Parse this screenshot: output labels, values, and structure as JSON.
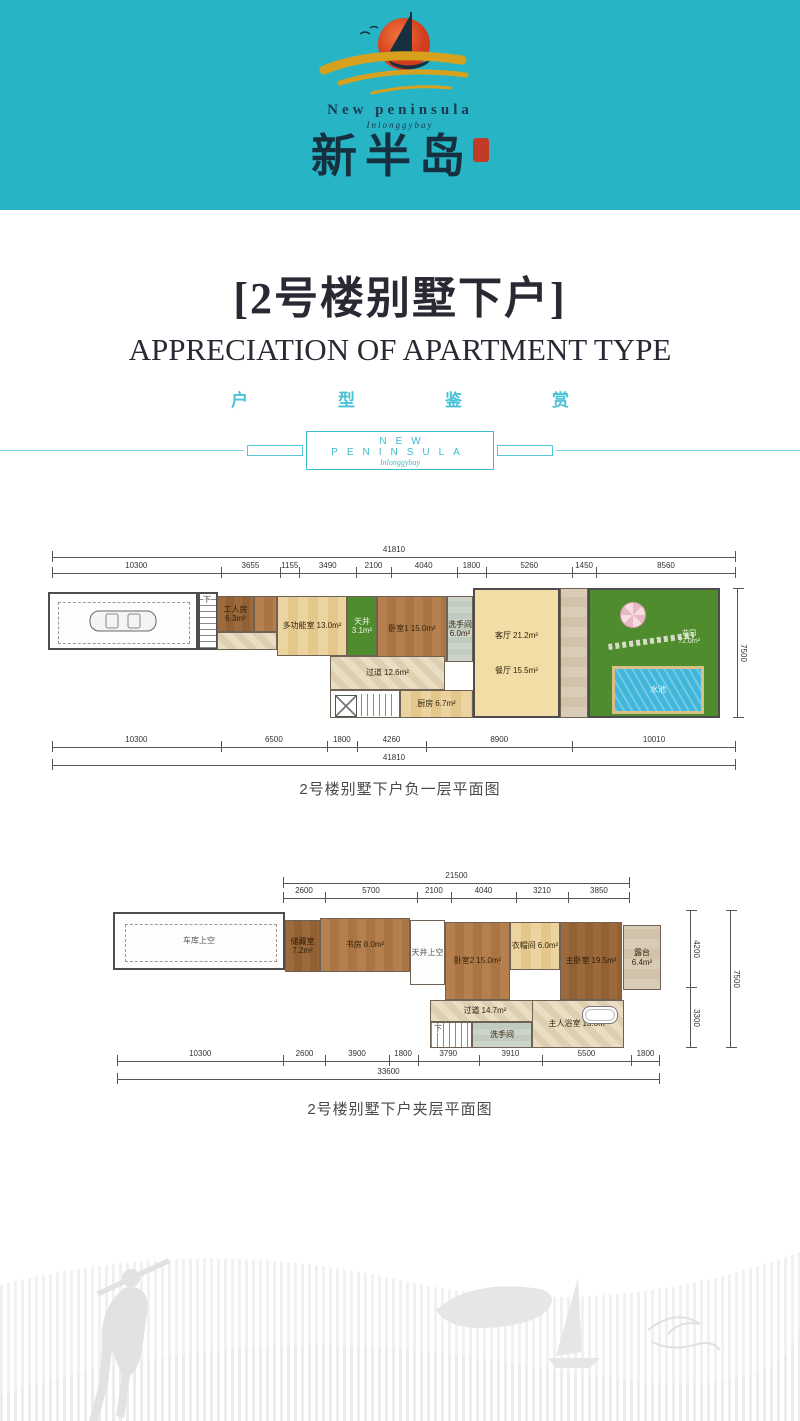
{
  "colors": {
    "brand_teal": "#27b5c5",
    "logo_navy": "#1c3850",
    "sun_orange": "#e2502a",
    "gold_wave": "#d8a11d",
    "seal_red": "#c23b27",
    "title_dark": "#2b2833",
    "accent_teal": "#49c2d6",
    "grass_green": "#4e8c2e",
    "pool_blue": "#3fb6da"
  },
  "header": {
    "brand_en": "New peninsula",
    "brand_script": "Inlonggybay",
    "brand_cn": "新半岛"
  },
  "title": {
    "main": "[2号楼别墅下户]",
    "subtitle_en": "APPRECIATION OF APARTMENT TYPE",
    "subtitle_cn": "户型鉴赏",
    "divider_label": "NEW PENINSULA",
    "divider_script": "Inlonggybay"
  },
  "plan1": {
    "caption": "2号楼别墅下户负一层平面图",
    "top_total": [
      "41810"
    ],
    "top_dims": [
      "10300",
      "3655",
      "1155",
      "3490",
      "2100",
      "4040",
      "1800",
      "5260",
      "1450",
      "8560"
    ],
    "bottom_dims": [
      "10300",
      "6500",
      "1800",
      "4260",
      "8900",
      "10010"
    ],
    "bottom_total": [
      "41810"
    ],
    "right_total": [
      "7500"
    ],
    "rooms": {
      "stair_label": "下",
      "worker": {
        "name": "工人房",
        "area": "6.3m²"
      },
      "multi": {
        "name": "多功能室",
        "area": "13.0m²"
      },
      "courtyard": {
        "name": "天井",
        "area": "3.1m²"
      },
      "bedroom1": {
        "name": "卧室1",
        "area": "15.0m²"
      },
      "bath": {
        "name": "洗手间",
        "area": "6.0m²"
      },
      "living": {
        "name": "客厅",
        "area": "21.2m²"
      },
      "dining": {
        "name": "餐厅",
        "area": "15.5m²"
      },
      "corridor": {
        "name": "过道",
        "area": "12.6m²"
      },
      "kitchen": {
        "name": "厨房",
        "area": "6.7m²"
      },
      "garden": {
        "name": "花园",
        "area": "72.0m²"
      },
      "pool": {
        "name": "水池"
      }
    }
  },
  "plan2": {
    "caption": "2号楼别墅下户夹层平面图",
    "top_total": [
      "21500"
    ],
    "top_dims": [
      "2600",
      "5700",
      "2100",
      "4040",
      "3210",
      "3850"
    ],
    "bottom_dims": [
      "10300",
      "2600",
      "3900",
      "1800",
      "3790",
      "3910",
      "5500",
      "1800"
    ],
    "bottom_total": [
      "33600"
    ],
    "right_dims": [
      "4200",
      "3300"
    ],
    "right_total": [
      "7500"
    ],
    "rooms": {
      "stair_label": "下",
      "garage_void": "车库上空",
      "storage": {
        "name": "储藏室",
        "area": "7.2m²"
      },
      "study": {
        "name": "书房",
        "area": "8.0m²"
      },
      "atrium_void": "天井上空",
      "bedroom2": {
        "name": "卧室2",
        "area": "15.0m²"
      },
      "cloak": {
        "name": "衣帽间",
        "area": "6.0m²"
      },
      "master": {
        "name": "主卧室",
        "area": "19.5m²"
      },
      "terrace": {
        "name": "露台",
        "area": "6.4m²"
      },
      "corridor": {
        "name": "过道",
        "area": "14.7m²"
      },
      "wash": {
        "name": "洗手间"
      },
      "master_bath": {
        "name": "主人浴室",
        "area": "13.0m²"
      }
    }
  }
}
